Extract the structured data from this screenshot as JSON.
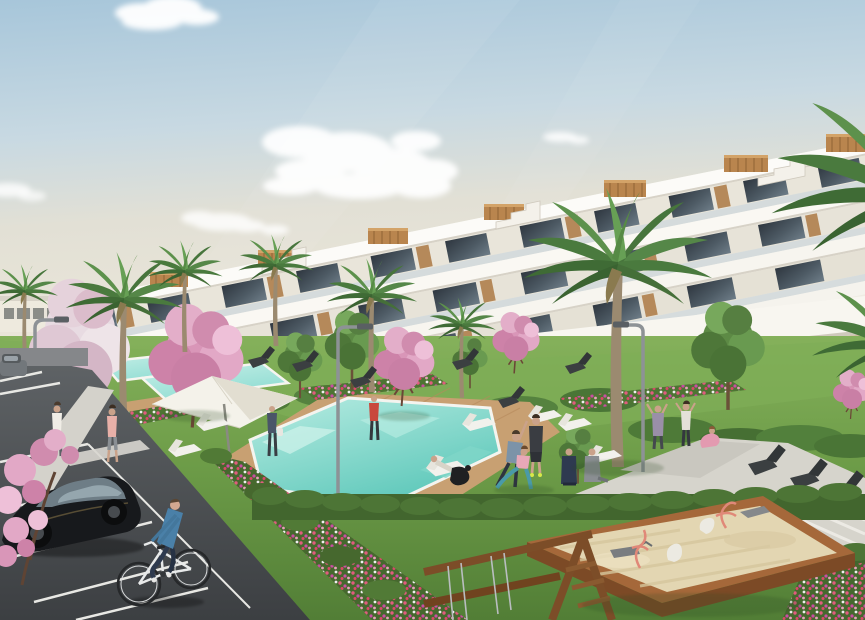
{
  "scene": {
    "type": "architectural-render",
    "description": "Photorealistic render of a modern white terraced apartment complex with wooden accents, communal turquoise pools, lawns with palm and pink blossom trees, people exercising by the pool, a parking lot with a black car and a cyclist, and a children's playground with a wooden sandbox and swing frame under a pale blue sky.",
    "time_of_day": "daytime",
    "people_count": 14,
    "objects": [
      {
        "name": "apartment-building",
        "description": "white stepped terraces, glass balconies, wood panel accents, rooftop pergola boxes"
      },
      {
        "name": "distant-buildings",
        "description": "low white commercial buildings on left horizon"
      },
      {
        "name": "main-pool",
        "description": "large turquoise pool with wooden deck surround"
      },
      {
        "name": "upper-pools",
        "description": "two smaller terraced lap pools upslope"
      },
      {
        "name": "sun-umbrella",
        "description": "large white parasol over a lounger"
      },
      {
        "name": "white-loungers",
        "description": "white chaise longues around pools"
      },
      {
        "name": "dark-lounge-chairs",
        "description": "dark angular designer chairs on lawn and walkway"
      },
      {
        "name": "street-lamps",
        "description": "three curved gray park lamps"
      },
      {
        "name": "big-palm",
        "description": "large date palm in front of facade"
      },
      {
        "name": "pink-blossom-trees",
        "description": "flowering trees in pink and white"
      },
      {
        "name": "flower-beds",
        "description": "strips of red, pink, purple and white flowers"
      },
      {
        "name": "hedges",
        "description": "clipped dark green hedgerows"
      },
      {
        "name": "parking-lot",
        "description": "asphalt with white bay markings"
      },
      {
        "name": "black-car",
        "description": "black hatchback parked in a bay"
      },
      {
        "name": "gray-car",
        "description": "distant parked gray car at left edge"
      },
      {
        "name": "cyclist",
        "description": "man in blue sweater and jeans on a white bicycle"
      },
      {
        "name": "pedestrians",
        "description": "two people walking on the sidewalk"
      },
      {
        "name": "yoga-group",
        "description": "people stretching and exercising on the lawn by the pool"
      },
      {
        "name": "sandbox",
        "description": "wooden-framed sandbox with coral spring riders and toys"
      },
      {
        "name": "swing-frame",
        "description": "wooden swing/climbing frame in the foreground corner"
      }
    ],
    "palette": {
      "sky_top": "#aac8db",
      "sky_horizon": "#ece7da",
      "cloud": "#ffffff",
      "facade_white": "#f1eee6",
      "facade_bright": "#fcfbf8",
      "window_glass": "#39414a",
      "wood_accent": "#b5895a",
      "palm_green": "#4a7a3e",
      "leaf_light": "#6fa355",
      "blossom_pink": "#d996b8",
      "blossom_white": "#e8dbe2",
      "grass": "#6d9c48",
      "grass_dark": "#527e36",
      "hedge": "#42662e",
      "pool_light": "#aee9df",
      "pool_deep": "#62c9bc",
      "deck_wood": "#c8a072",
      "sand": "#e3d6b2",
      "sandbox_wood": "#a5683a",
      "asphalt": "#4a4e51",
      "marking_white": "#e8e8e4",
      "path_gray": "#d4d2cb",
      "car_black": "#17191c",
      "denim_blue": "#4a80a8",
      "flower_red": "#d9486a",
      "flower_purple": "#c94da3",
      "lamp_gray": "#8d9296"
    }
  }
}
